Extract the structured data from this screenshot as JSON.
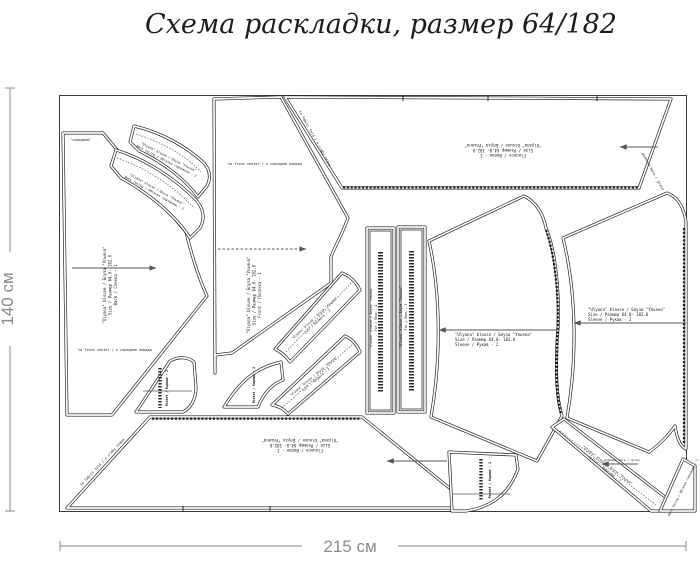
{
  "title": "Схема раскладки, размер 64/182",
  "fabric": {
    "height_label": "140 см",
    "width_label": "215 см"
  },
  "colors": {
    "outline": "#161616",
    "dimension": "#8a8a8a",
    "background": "#ffffff"
  },
  "labels": {
    "series": "\"Ulyana\" blouse / Блуза \"Ульяна\"",
    "size": "Size / Размер  64.0- 182.0",
    "back": "Back / Спинка - 1",
    "front": "Front / Полочка - 1",
    "sleeve": "Sleeve / Рукав - 2",
    "flounce": "Flounce / Волан - 1",
    "tie": "Tie / Пояс - 2",
    "facing": "Neck facing / Обтачка горловины - 2",
    "cuff": "Cuff / Манжета - 2",
    "pocket": "Pocket / Карман - 2",
    "collar": "Collar / Воротник - 1",
    "center_front": "to front center / к середине переда",
    "fold": "to fabric fold / к сгибу ткани",
    "middle": "\"середина\"",
    "grain": "долевая нить / grain"
  },
  "pieces": [
    "back-bodice",
    "front-bodice",
    "back-flounce",
    "front-flounce",
    "sleeve-left",
    "sleeve-right",
    "tie-left",
    "tie-right",
    "neck-facing-upper",
    "neck-facing-lower",
    "cuff-upper",
    "cuff-lower",
    "pocket-small",
    "pocket-curved",
    "pocket-bottom",
    "collar-band",
    "corner-piece"
  ]
}
